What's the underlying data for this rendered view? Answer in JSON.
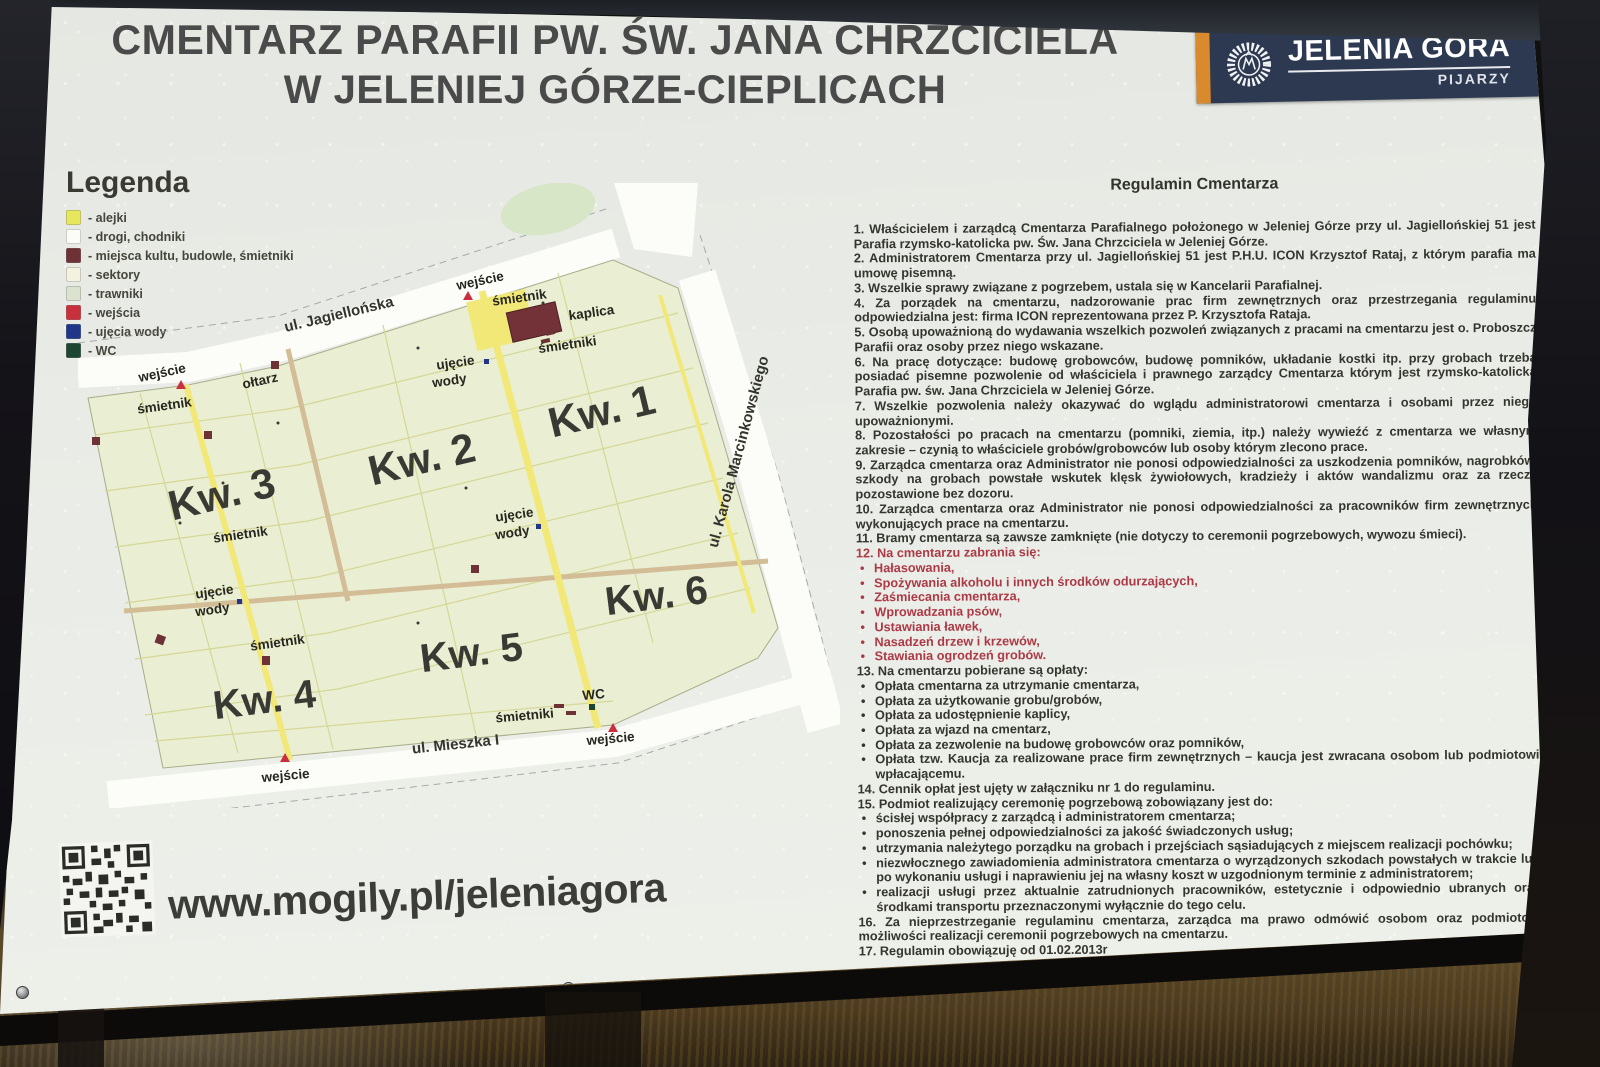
{
  "title": {
    "line1": "CMENTARZ PARAFII PW. ŚW. JANA CHRZCICIELA",
    "line2": "W JELENIEJ GÓRZE-CIEPLICACH"
  },
  "logo": {
    "city": "JELENIA GÓRA",
    "sub": "PIJARZY",
    "accent_color": "#d88a2d",
    "band_color": "#2c3950"
  },
  "legend": {
    "heading": "Legenda",
    "items": [
      {
        "label": "- alejki",
        "color": "#e6e75c"
      },
      {
        "label": "- drogi, chodniki",
        "color": "#fbfbf7"
      },
      {
        "label": "- miejsca kultu, budowle, śmietniki",
        "color": "#6d3136"
      },
      {
        "label": "- sektory",
        "color": "#f3f2e0"
      },
      {
        "label": "- trawniki",
        "color": "#dbe3d0"
      },
      {
        "label": "- wejścia",
        "color": "#c9303d"
      },
      {
        "label": "- ujęcia wody",
        "color": "#20368b"
      },
      {
        "label": "- WC",
        "color": "#1c4631"
      }
    ]
  },
  "map": {
    "streets": {
      "jagiellonska": "ul. Jagiellońska",
      "marcinkowskiego": "ul. Karola Marcinkowskiego",
      "mieszka": "ul. Mieszka I"
    },
    "quarters": {
      "q1": "Kw. 1",
      "q2": "Kw. 2",
      "q3": "Kw. 3",
      "q4": "Kw. 4",
      "q5": "Kw. 5",
      "q6": "Kw. 6"
    },
    "labels": {
      "entrance": "wejście",
      "bin": "śmietnik",
      "bins": "śmietniki",
      "chapel": "kaplica",
      "altar": "ołtarz",
      "water_line1": "ujęcie",
      "water_line2": "wody",
      "wc": "WC"
    }
  },
  "regulamin": {
    "heading": "Regulamin Cmentarza",
    "items": [
      {
        "style": "num",
        "text": "1.  Właścicielem i zarządcą Cmentarza Parafialnego położonego w Jeleniej Górze przy ul. Jagiellońskiej 51 jest Parafia rzymsko-katolicka pw. Św. Jana Chrzciciela w Jeleniej Górze."
      },
      {
        "style": "num",
        "text": "2.  Administratorem Cmentarza przy ul. Jagiellońskiej 51 jest P.H.U. ICON Krzysztof Rataj, z którym parafia ma umowę pisemną."
      },
      {
        "style": "num",
        "text": "3.  Wszelkie sprawy związane z pogrzebem, ustala się w Kancelarii Parafialnej."
      },
      {
        "style": "num",
        "text": "4.  Za porządek na cmentarzu, nadzorowanie prac firm zewnętrznych oraz przestrzegania regulaminu odpowiedzialna jest: firma  ICON  reprezentowana przez P. Krzysztofa Rataja."
      },
      {
        "style": "num",
        "text": "5.  Osobą upoważnioną do wydawania wszelkich pozwoleń związanych z pracami na cmentarzu jest o. Proboszcz Parafii oraz osoby przez niego wskazane."
      },
      {
        "style": "num",
        "text": "6.  Na pracę dotyczące: budowę grobowców, budowę pomników, układanie kostki itp. przy grobach trzeba posiadać pisemne pozwolenie od właściciela i prawnego zarządcy Cmentarza którym jest rzymsko-katolicka Parafia pw. św. Jana Chrzciciela w Jeleniej Górze."
      },
      {
        "style": "num",
        "text": "7.  Wszelkie pozwolenia należy okazywać do wglądu administratorowi cmentarza i osobami przez niego upoważnionymi."
      },
      {
        "style": "num",
        "text": "8.  Pozostałości po pracach na cmentarzu (pomniki, ziemia, itp.) należy wywieźć z cmentarza we własnym zakresie – czynią to właściciele grobów/grobowców lub osoby którym zlecono prace."
      },
      {
        "style": "num",
        "text": "9.  Zarządca cmentarza oraz Administrator nie ponosi odpowiedzialności za uszkodzenia pomników, nagrobków, szkody na grobach powstałe wskutek klęsk żywiołowych, kradzieży i aktów wandalizmu oraz za rzeczy pozostawione bez dozoru."
      },
      {
        "style": "num",
        "text": "10.   Zarządca cmentarza oraz Administrator nie ponosi odpowiedzialności za pracowników firm zewnętrznych wykonujących prace na cmentarzu."
      },
      {
        "style": "num",
        "text": "11. Bramy cmentarza są zawsze zamknięte (nie dotyczy to ceremonii pogrzebowych, wywozu śmieci)."
      },
      {
        "style": "num-red",
        "text": "12. Na cmentarzu zabrania się:"
      },
      {
        "style": "bullet-red",
        "text": "Hałasowania,"
      },
      {
        "style": "bullet-red",
        "text": "Spożywania alkoholu i innych środków odurzających,"
      },
      {
        "style": "bullet-red",
        "text": "Zaśmiecania cmentarza,"
      },
      {
        "style": "bullet-red",
        "text": "Wprowadzania psów,"
      },
      {
        "style": "bullet-red",
        "text": "Ustawiania ławek,"
      },
      {
        "style": "bullet-red",
        "text": "Nasadzeń drzew i krzewów,"
      },
      {
        "style": "bullet-red",
        "text": "Stawiania ogrodzeń grobów."
      },
      {
        "style": "num",
        "text": "13. Na cmentarzu pobierane są opłaty:"
      },
      {
        "style": "bullet",
        "text": "Opłata cmentarna za utrzymanie cmentarza,"
      },
      {
        "style": "bullet",
        "text": "Opłata za użytkowanie grobu/grobów,"
      },
      {
        "style": "bullet",
        "text": "Opłata za udostępnienie kaplicy,"
      },
      {
        "style": "bullet",
        "text": "Opłata za wjazd na cmentarz,"
      },
      {
        "style": "bullet",
        "text": "Opłata za zezwolenie na budowę grobowców oraz pomników,"
      },
      {
        "style": "bullet",
        "text": "Opłata tzw. Kaucja za realizowane prace firm zewnętrznych – kaucja jest zwracana osobom lub podmiotowi wpłacającemu."
      },
      {
        "style": "num",
        "text": "14. Cennik opłat jest ujęty w załączniku nr 1 do regulaminu."
      },
      {
        "style": "num",
        "text": "15. Podmiot realizujący ceremonię pogrzebową zobowiązany jest do:"
      },
      {
        "style": "bullet",
        "text": "ścisłej współpracy z zarządcą i administratorem cmentarza;"
      },
      {
        "style": "bullet",
        "text": "ponoszenia pełnej odpowiedzialności za jakość świadczonych usług;"
      },
      {
        "style": "bullet",
        "text": "utrzymania należytego porządku na grobach i przejściach sąsiadujących z miejscem realizacji pochówku;"
      },
      {
        "style": "bullet",
        "text": "niezwłocznego zawiadomienia administratora cmentarza o wyrządzonych szkodach powstałych w trakcie lub po wykonaniu usługi i naprawieniu jej na własny koszt w uzgodnionym terminie z administratorem;"
      },
      {
        "style": "bullet",
        "text": "realizacji usługi przez aktualnie zatrudnionych pracowników, estetycznie i odpowiednio ubranych oraz środkami transportu przeznaczonymi wyłącznie do tego celu."
      },
      {
        "style": "num",
        "text": "16. Za nieprzestrzeganie regulaminu cmentarza, zarządca ma prawo odmówić osobom oraz podmiotom możliwości realizacji ceremonii pogrzebowych na cmentarzu."
      },
      {
        "style": "num",
        "text": "17. Regulamin obowiązuję od 01.02.2013r"
      }
    ]
  },
  "footer": {
    "url": "www.mogily.pl/jeleniagora"
  }
}
